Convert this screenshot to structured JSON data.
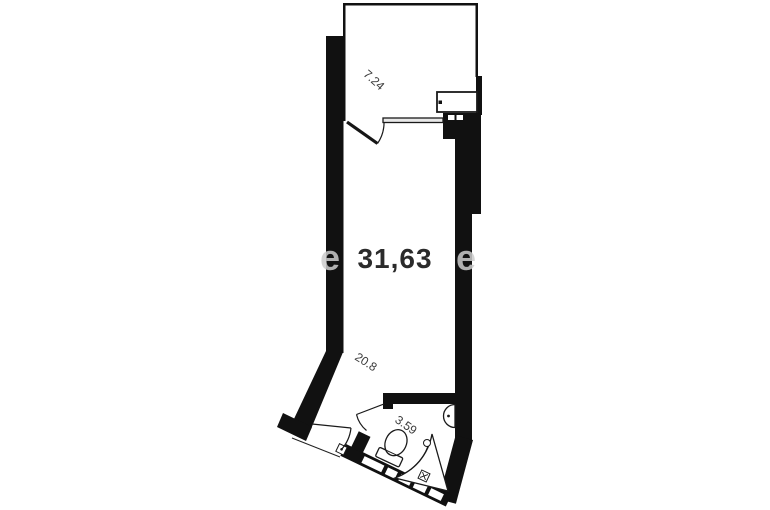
{
  "floorplan": {
    "description": "Studio apartment floor plan",
    "colors": {
      "background": "#ffffff",
      "walls": "#111111",
      "labels": "#3a3a3a",
      "watermark": "#cccccc"
    },
    "rooms": [
      {
        "id": "balcony",
        "area_label": "7.24"
      },
      {
        "id": "living-area",
        "area_label": "31,63"
      },
      {
        "id": "lower-room",
        "area_label": "20.8"
      },
      {
        "id": "bathroom",
        "area_label": "3.59"
      }
    ],
    "watermark": {
      "left": "e",
      "right": "e"
    },
    "fixtures": [
      {
        "name": "kitchen-unit"
      },
      {
        "name": "vent-shaft"
      },
      {
        "name": "toilet"
      },
      {
        "name": "corner-bath"
      },
      {
        "name": "wall-sink"
      }
    ]
  }
}
